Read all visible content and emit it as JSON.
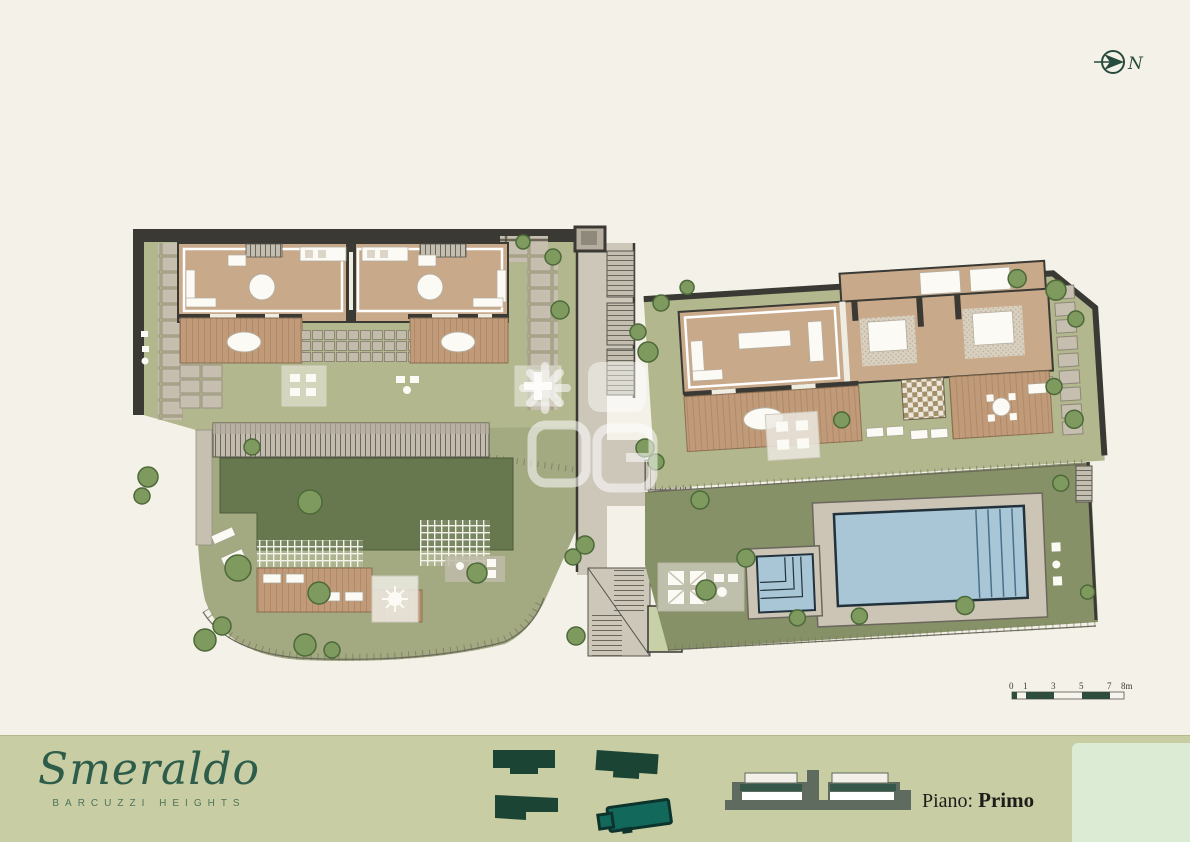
{
  "north_indicator": {
    "label": "N"
  },
  "scale_bar": {
    "ticks": [
      "0",
      "1",
      "3",
      "5",
      "7",
      "8m"
    ]
  },
  "footer": {
    "brand": "Smeraldo",
    "subtitle": "BARCUZZI HEIGHTS",
    "floor_label": "Piano:",
    "floor_value": "Primo"
  },
  "plan_colors": {
    "background": "#f4f1e9",
    "lawn": "#b2b78d",
    "lawn_dark": "#67784e",
    "pool_lawn": "#879168",
    "wood_floor": "#c8a98a",
    "wood_deck": "#c19b79",
    "wall": "#3a3934",
    "paving": "#c6bfb0",
    "path": "#cdc7ba",
    "water": "#a9c6d6",
    "tree": "#7e9a5e",
    "footer_band": "#c9cda3",
    "brand_green": "#2d5c4a",
    "keyplan_green": "#1c4435",
    "keyplan_active_teal": "#13685c",
    "scale_dark": "#2e4d3c"
  }
}
